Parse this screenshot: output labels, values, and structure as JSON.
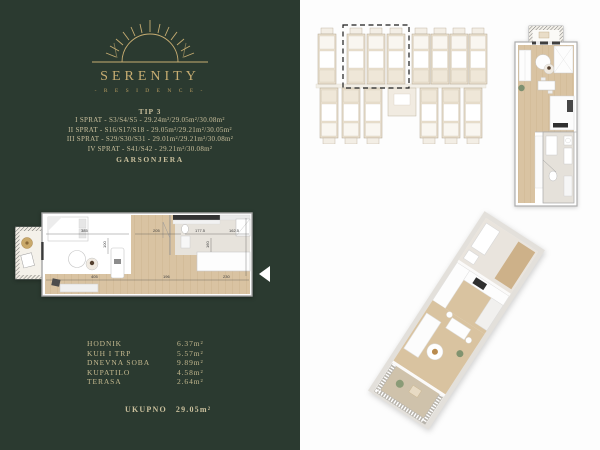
{
  "brand": {
    "name": "SERENITY",
    "subtitle": "- R E S I D E N C E -"
  },
  "unit_info": {
    "type_label": "TIP 3",
    "floors": [
      "I SPRAT - S3/S4/S5 - 29.24m²/29.05m²/30.08m²",
      "II SPRAT - S16/S17/S18 - 29.05m²/29.21m²/30.05m²",
      "III SPRAT - S29/S30/S31 - 29.01m²/29.21m²/30.08m²",
      "IV SPRAT - S41/S42 - 29.21m²/30.08m²"
    ],
    "category": "GARSONJERA"
  },
  "rooms": [
    {
      "name": "HODNIK",
      "area": "6.37m²"
    },
    {
      "name": "KUH I TRP",
      "area": "5.57m²"
    },
    {
      "name": "DNEVNA SOBA",
      "area": "9.89m²"
    },
    {
      "name": "KUPATILO",
      "area": "4.58m²"
    },
    {
      "name": "TERASA",
      "area": "2.64m²"
    }
  ],
  "total": {
    "label": "UKUPNO",
    "value": "29.05m²"
  },
  "plan_dimensions": [
    "385",
    "205",
    "177.5",
    "162.5",
    "100",
    "160",
    "405",
    "196",
    "230"
  ],
  "colors": {
    "panel_green": "#2b3a30",
    "logo_gold": "#c7ad72",
    "text_gold": "#c9bf9c",
    "wood_floor": "#d9c3a2",
    "highlight_dash": "#1c1c1c"
  }
}
